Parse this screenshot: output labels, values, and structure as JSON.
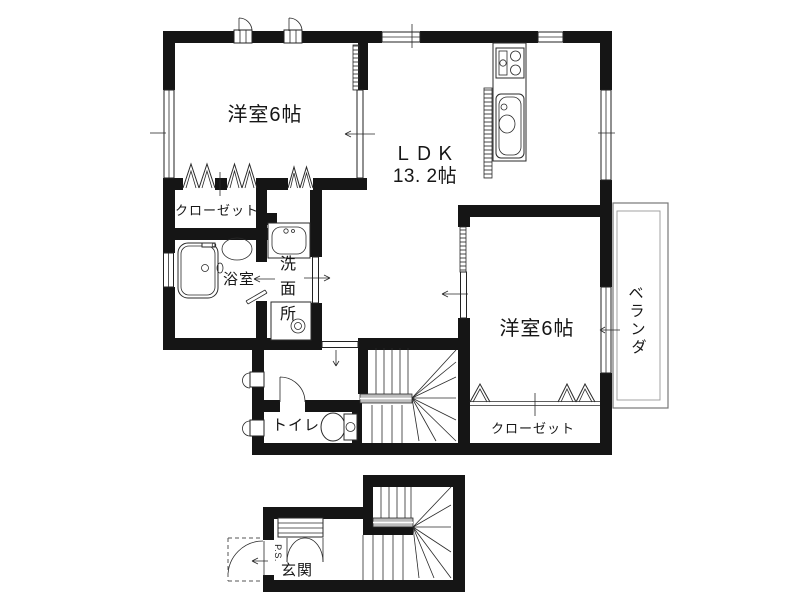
{
  "document_type": "floor-plan",
  "colors": {
    "walls": "#151515",
    "lines": "#2a2a2a",
    "background": "#ffffff",
    "stair_landing_band": "#bdbdbd",
    "veranda_outline": "#777777"
  },
  "floor_2f": {
    "bedroom1": {
      "label": "洋室6帖"
    },
    "ldk": {
      "name": "ＬＤＫ",
      "area": "13. 2帖"
    },
    "closet_west": {
      "label": "クローゼット"
    },
    "bathroom": {
      "label": "浴室"
    },
    "washroom": {
      "label": "洗面所",
      "chars": [
        "洗",
        "面",
        "所"
      ]
    },
    "bedroom2": {
      "label": "洋室6帖"
    },
    "veranda": {
      "label": "ベランダ",
      "chars": [
        "ベ",
        "ラ",
        "ン",
        "ダ"
      ]
    },
    "closet_east": {
      "label": "クローゼット"
    },
    "toilet": {
      "label": "トイレ"
    }
  },
  "floor_1f": {
    "entrance": {
      "label": "玄関"
    },
    "pipe_space": {
      "label": "P.S."
    }
  }
}
